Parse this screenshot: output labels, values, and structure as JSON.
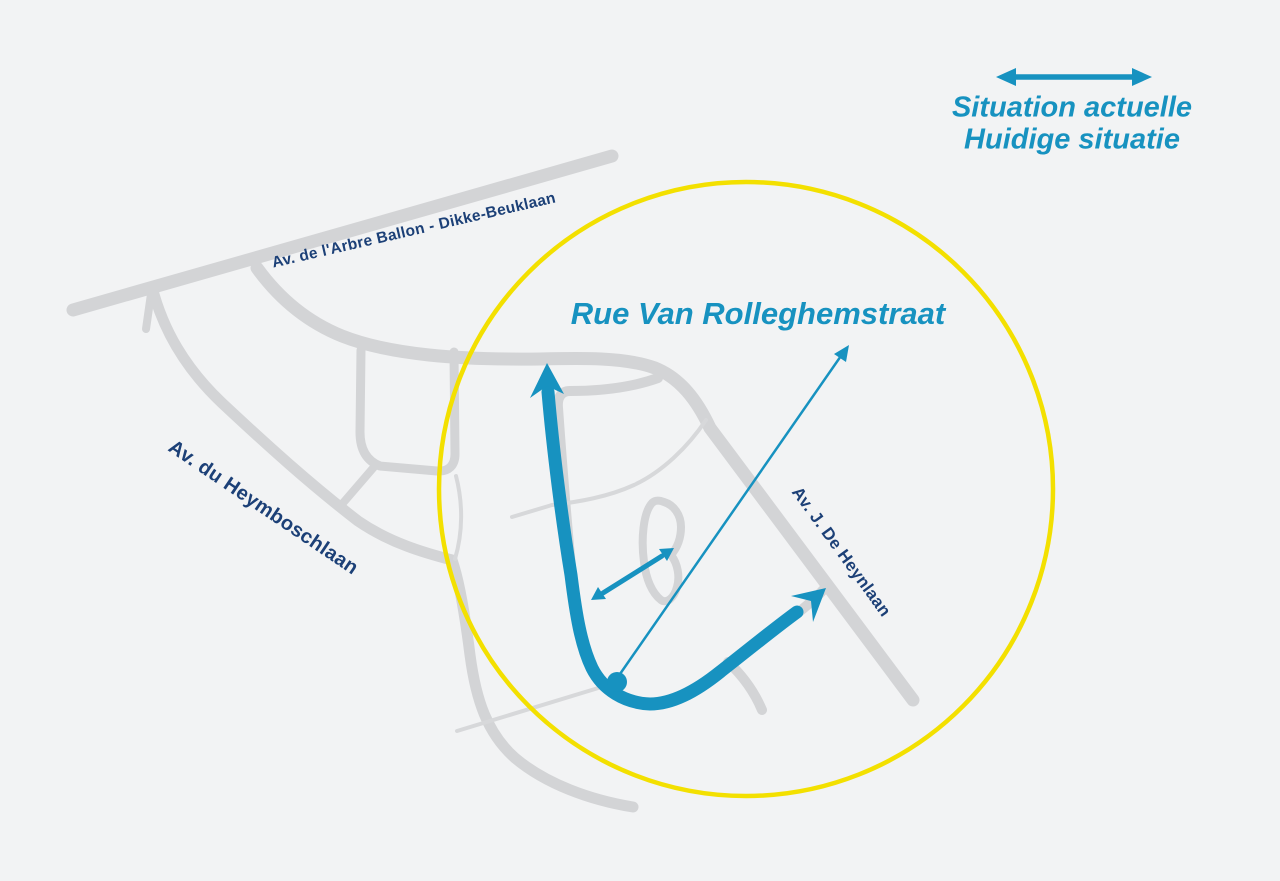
{
  "legend": {
    "line1": "Situation actuelle",
    "line2": "Huidige situatie"
  },
  "map": {
    "title": "Rue Van Rolleghemstraat",
    "streets": [
      {
        "name": "Av. de l'Arbre Ballon - Dikke-Beuklaan"
      },
      {
        "name": "Av. du Heymboschlaan"
      },
      {
        "name": "Av. J. De Heynlaan"
      }
    ]
  },
  "colors": {
    "background": "#f2f3f4",
    "road-gray": "#d3d4d6",
    "road-gray-thin": "#d7d8da",
    "accent-teal": "#1792c0",
    "street-navy": "#1c4077",
    "highlight-yellow": "#f3e000"
  }
}
